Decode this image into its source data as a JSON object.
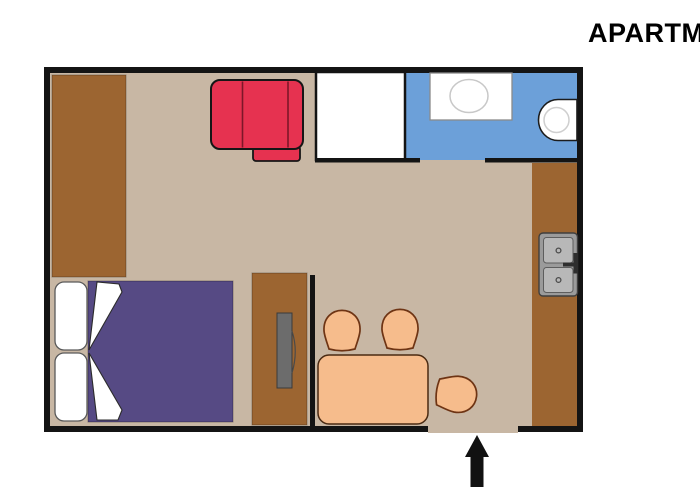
{
  "title": {
    "text": "APARTMENT"
  },
  "icons": {
    "entrance_arrow": "arrow-up-icon"
  },
  "colors": {
    "wall": "#141414",
    "floor": "#c8b7a4",
    "wood": "#9c6531",
    "sofa_red": "#e63250",
    "bathroom_blue": "#6ca0d9",
    "bed_purple": "#564a84",
    "furniture_peach": "#f6bc8c",
    "fixture_white": "#ffffff",
    "sink_gray": "#9b9b9b",
    "sink_basin_gray": "#b8b8b8",
    "desk_item_gray": "#6c6c6c",
    "arrow_black": "#111111"
  }
}
